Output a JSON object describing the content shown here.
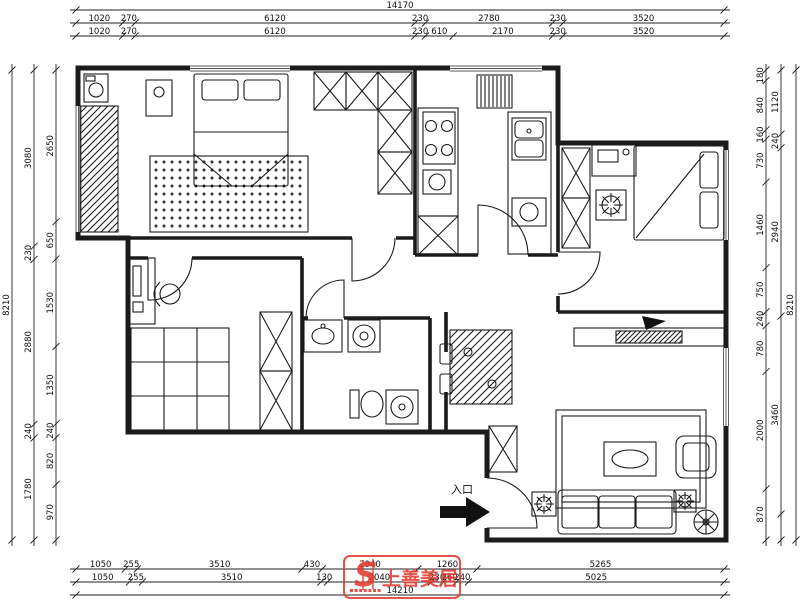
{
  "dimensions": {
    "top_total": "14170",
    "top_row2": [
      "1020",
      "270",
      "6120",
      "230",
      "2780",
      "230",
      "3520"
    ],
    "top_row3": [
      "1020",
      "270",
      "6120",
      "230",
      "610",
      "2170",
      "230",
      "3520"
    ],
    "bottom_row1": [
      "1050",
      "255",
      "3510",
      "430",
      "2040",
      "1260",
      "5265"
    ],
    "bottom_row2": [
      "1050",
      "255",
      "3510",
      "130",
      "2040",
      "230",
      "260",
      "240",
      "5025"
    ],
    "bottom_total": "14210",
    "left_outer": "8210",
    "left_mid": [
      "3080",
      "230",
      "2880",
      "240",
      "1780"
    ],
    "left_inner": [
      "2650",
      "650",
      "1530",
      "1350",
      "240",
      "820",
      "970"
    ],
    "right_inner": [
      "180",
      "840",
      "160",
      "730",
      "1460",
      "750",
      "240",
      "780",
      "2000",
      "870"
    ],
    "right_mid": [
      "1120",
      "240",
      "2940",
      "3460"
    ],
    "right_outer": "8210"
  },
  "entrance": {
    "label": "入口"
  },
  "watermark": {
    "logo_text": "S",
    "brand": "上善美居",
    "color": "#e23b2e"
  },
  "colors": {
    "line": "#1b1b1b",
    "dimension": "#222222",
    "watermark_red": "#e23b2e"
  }
}
